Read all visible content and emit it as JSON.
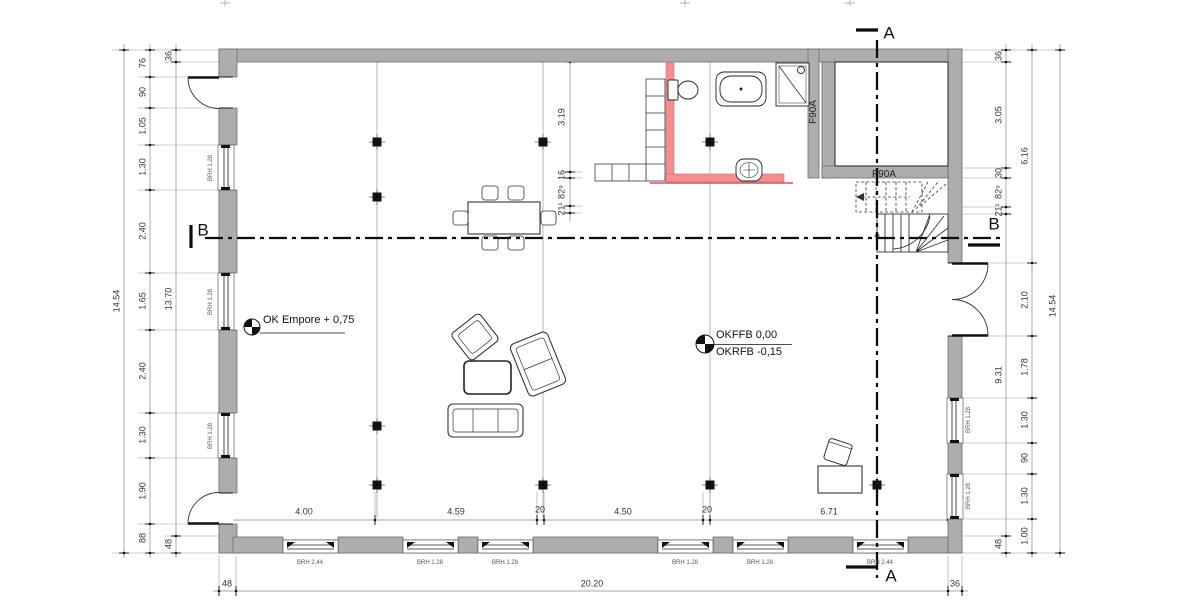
{
  "sections": {
    "a_top": "A",
    "a_bottom": "A",
    "b_left": "B",
    "b_right": "B"
  },
  "levels": {
    "empore": "OK Empore + 0,75",
    "ffb": "OKFFB 0,00",
    "rfb": "OKRFB -0,15"
  },
  "fire": {
    "vertical": "F90A",
    "horizontal": "F90A"
  },
  "dims": {
    "left_outer": "14.54",
    "left_chain": [
      "76",
      "90",
      "1.05",
      "1.30",
      "2.40",
      "1.65",
      "2.40",
      "1.30",
      "1.90",
      "88"
    ],
    "left_wall": [
      "36",
      "13.70",
      "48"
    ],
    "right_inner": [
      "36",
      "3.05",
      "30",
      "82⁹",
      "21¹",
      "9.31",
      "48"
    ],
    "right_mid": [
      "6.16",
      "2.10",
      "1.78",
      "1.30",
      "90",
      "1.30",
      "1.00"
    ],
    "right_outer": "14.54",
    "bottom_inner": [
      "4.00",
      "4.59",
      "20",
      "4.50",
      "20",
      "6.71"
    ],
    "bottom_outer": [
      "48",
      "20.20",
      "36"
    ],
    "interior": [
      "3.19",
      "16",
      "82⁹",
      "21¹"
    ]
  },
  "window_labels": {
    "bottom": [
      "BRH 2.44",
      "BRH 1.28",
      "BRH 1.28",
      "BRH 1.28",
      "BRH 1.28",
      "BRH 2.44"
    ],
    "left": [
      "BRH 1.28",
      "BRH 1.28",
      "BRH 1.28"
    ],
    "right": [
      "BRH 1.28",
      "BRH 1.28"
    ]
  },
  "colors": {
    "wall": "#adadad",
    "highlight": "#f58f8f",
    "highlight_line": "#e05050"
  }
}
